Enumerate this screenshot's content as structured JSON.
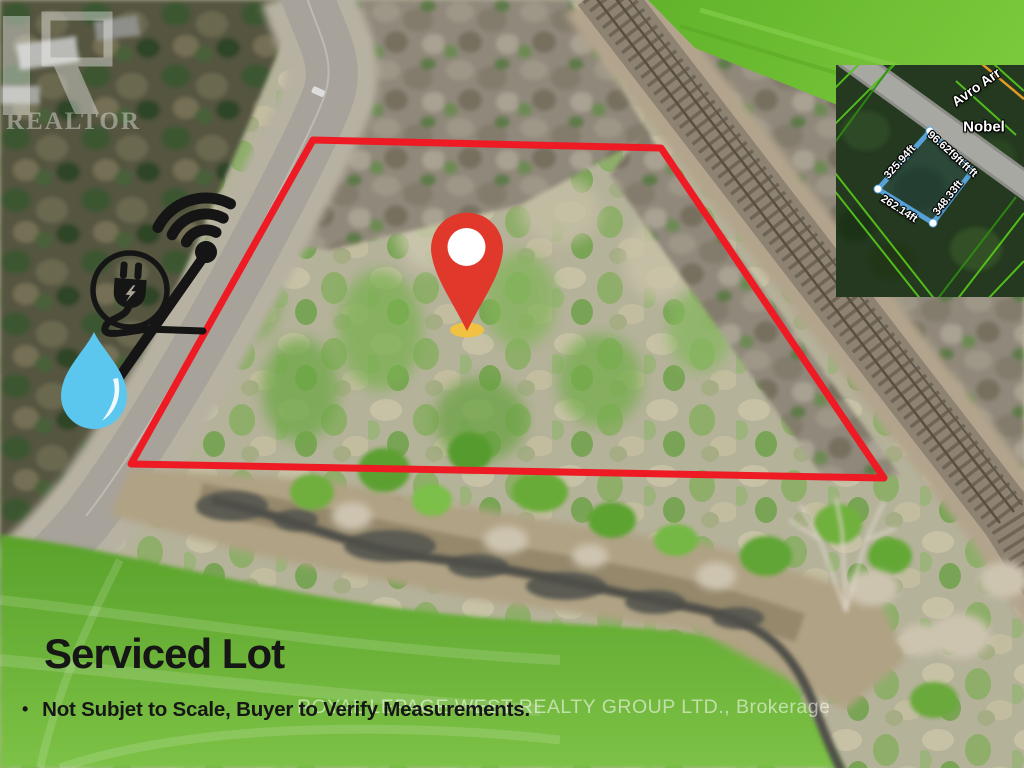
{
  "colors": {
    "boundary_red": "#ee1b24",
    "pin_red": "#e0392b",
    "pin_shadow_yellow": "#f1c141",
    "water_blue": "#5bc6ee",
    "icon_black": "#151515"
  },
  "caption": {
    "title": "Serviced Lot",
    "bullet": "•",
    "disclaimer": "Not Subjet to Scale, Buyer to Verify Measurements."
  },
  "watermarks": {
    "realtor_logo_text": "REALTOR",
    "brokerage": "ROYAL LEPAGE WEST REALTY GROUP LTD., Brokerage"
  },
  "annotations": {
    "marker": "location-pin",
    "utility_icons": [
      "wifi-icon",
      "power-plug-icon",
      "water-drop-icon"
    ]
  },
  "inset_map": {
    "road_label": "Avro Arr",
    "place_label": "Nobel",
    "dimensions": {
      "left_edge": "325.94ft",
      "frontage_segments": [
        "96.62ft",
        "9ft",
        "ft",
        "ft"
      ],
      "right_edge": "348.33ft",
      "bottom_edge": "262.14ft"
    }
  }
}
